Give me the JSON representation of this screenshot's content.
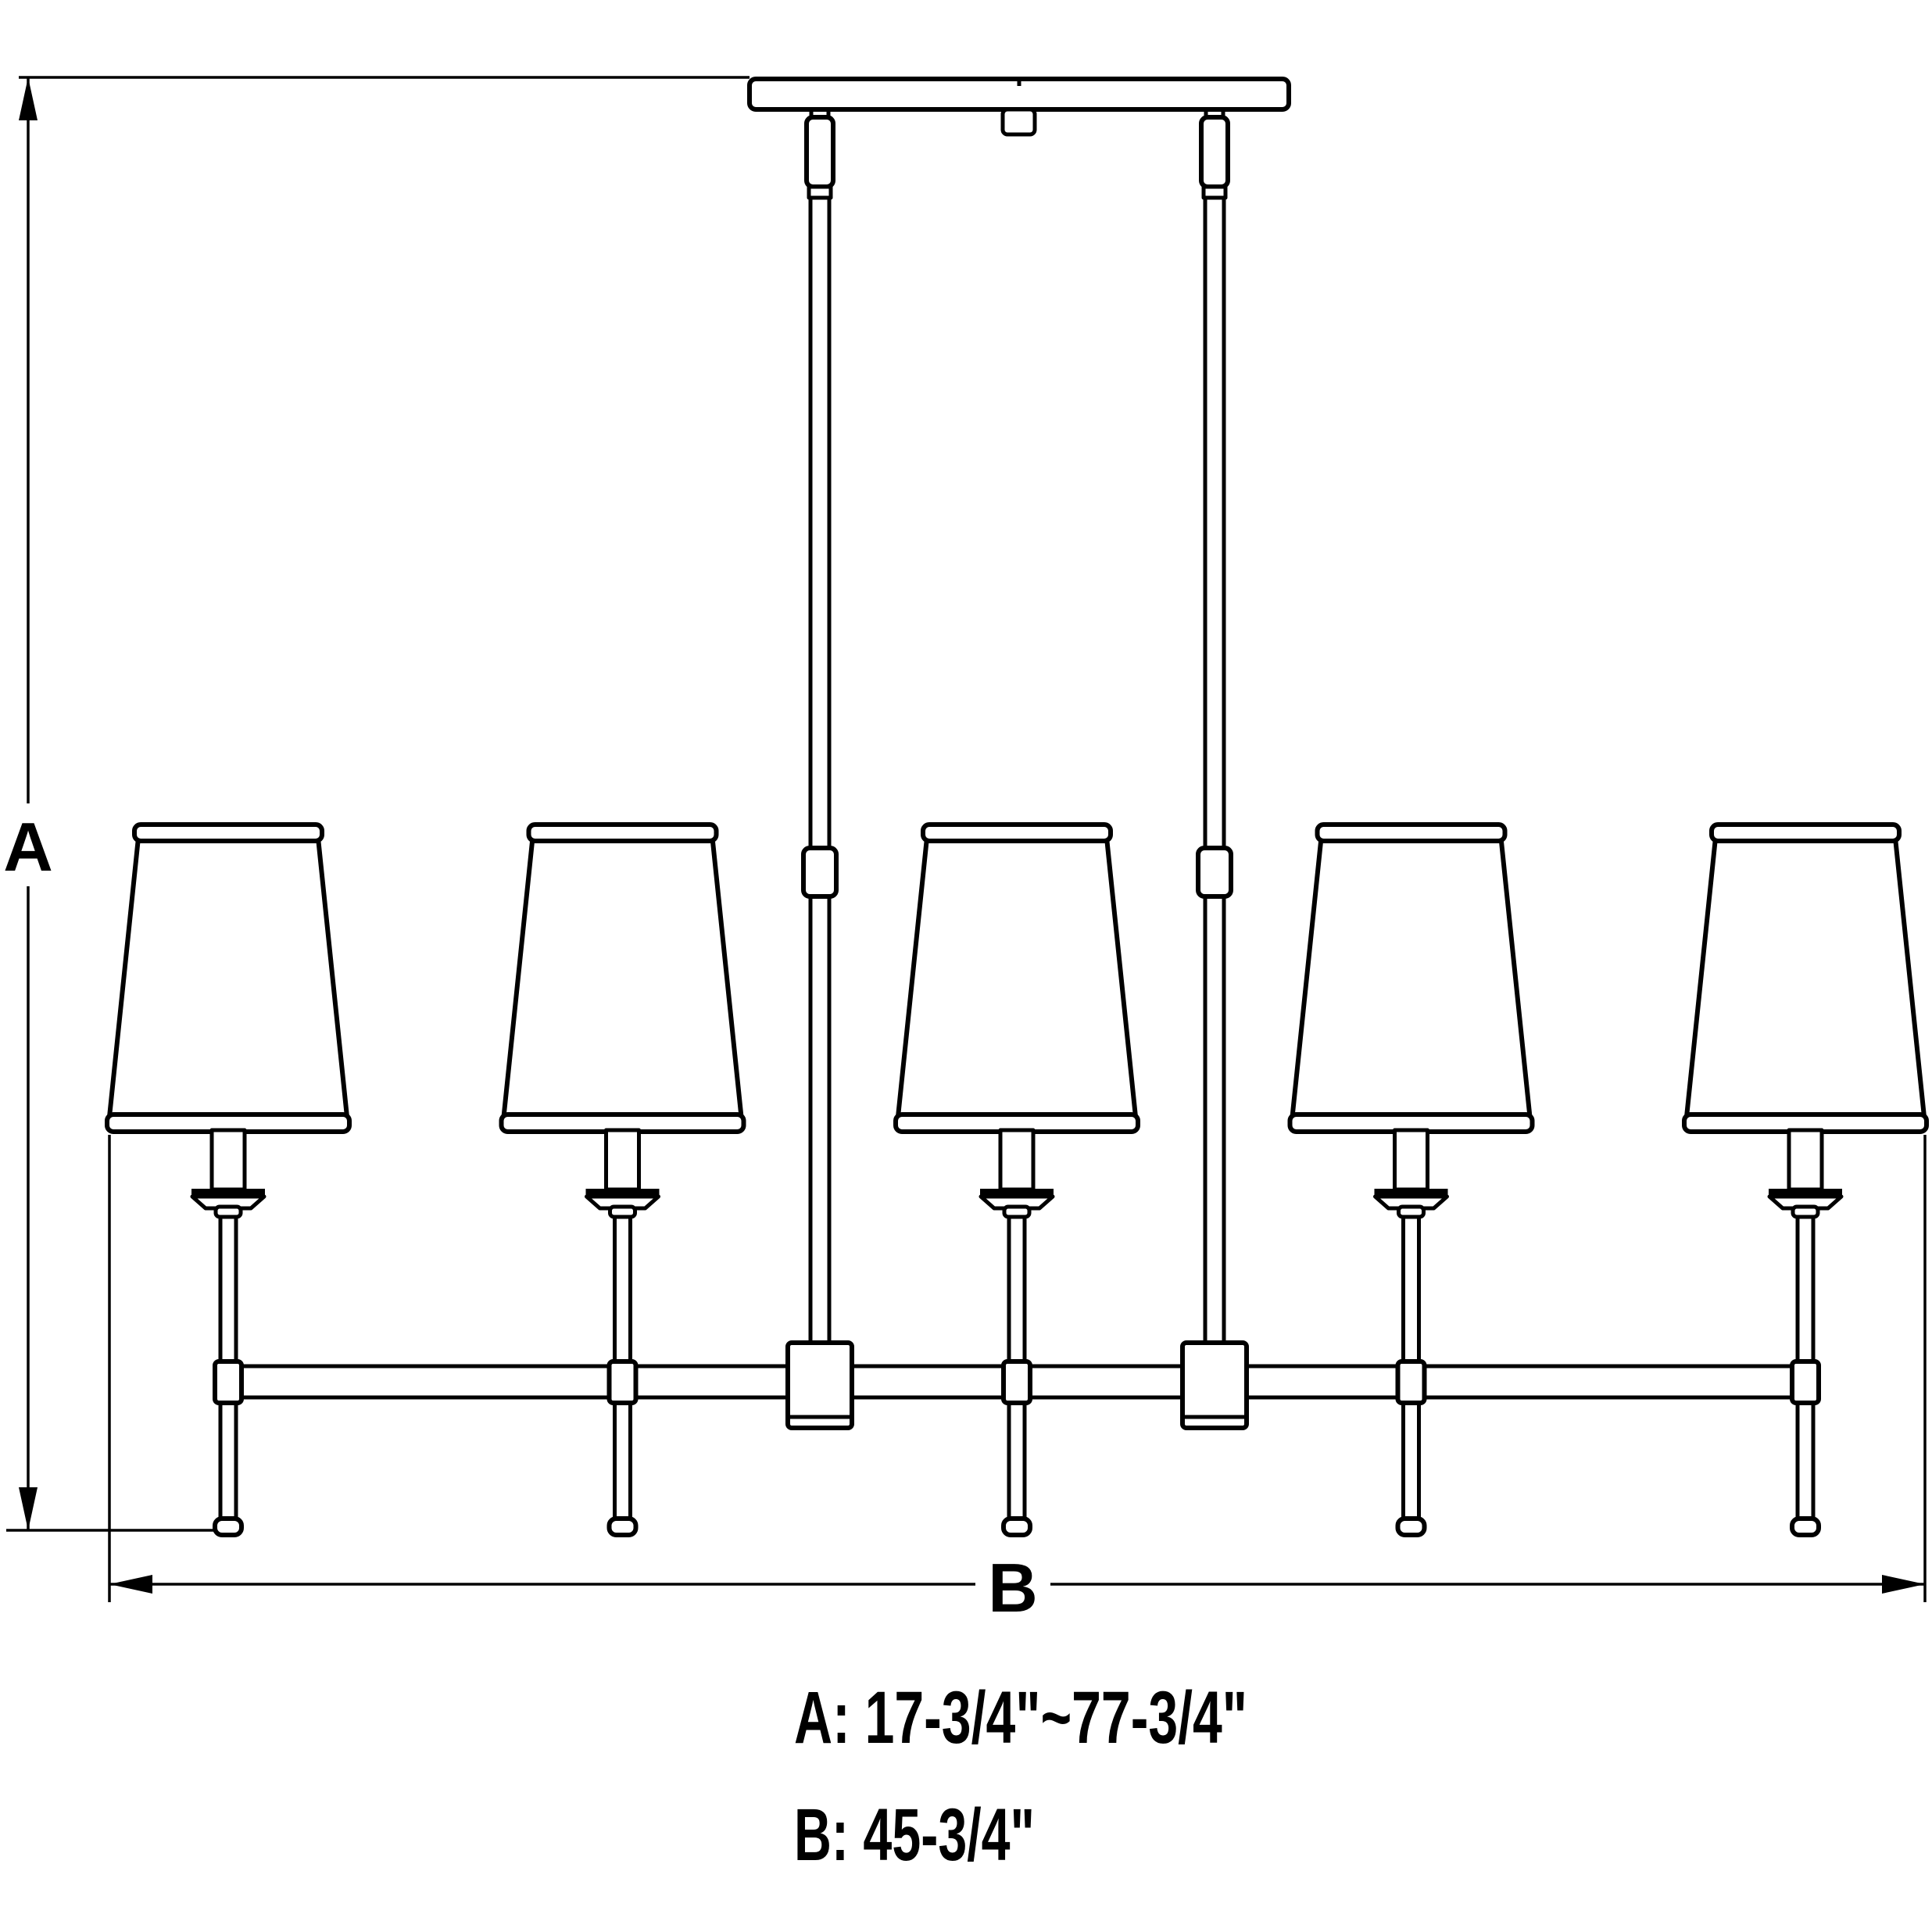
{
  "diagram": {
    "kind": "product-dimension-drawing",
    "subject": "5-light linear chandelier line drawing",
    "lights_count": 5,
    "dimension_labels": {
      "a": "A",
      "b": "B"
    },
    "specs": {
      "a": "A: 17-3/4\"~77-3/4\"",
      "b": "B: 45-3/4\""
    },
    "colors": {
      "line": "#000000",
      "background": "#ffffff"
    }
  }
}
